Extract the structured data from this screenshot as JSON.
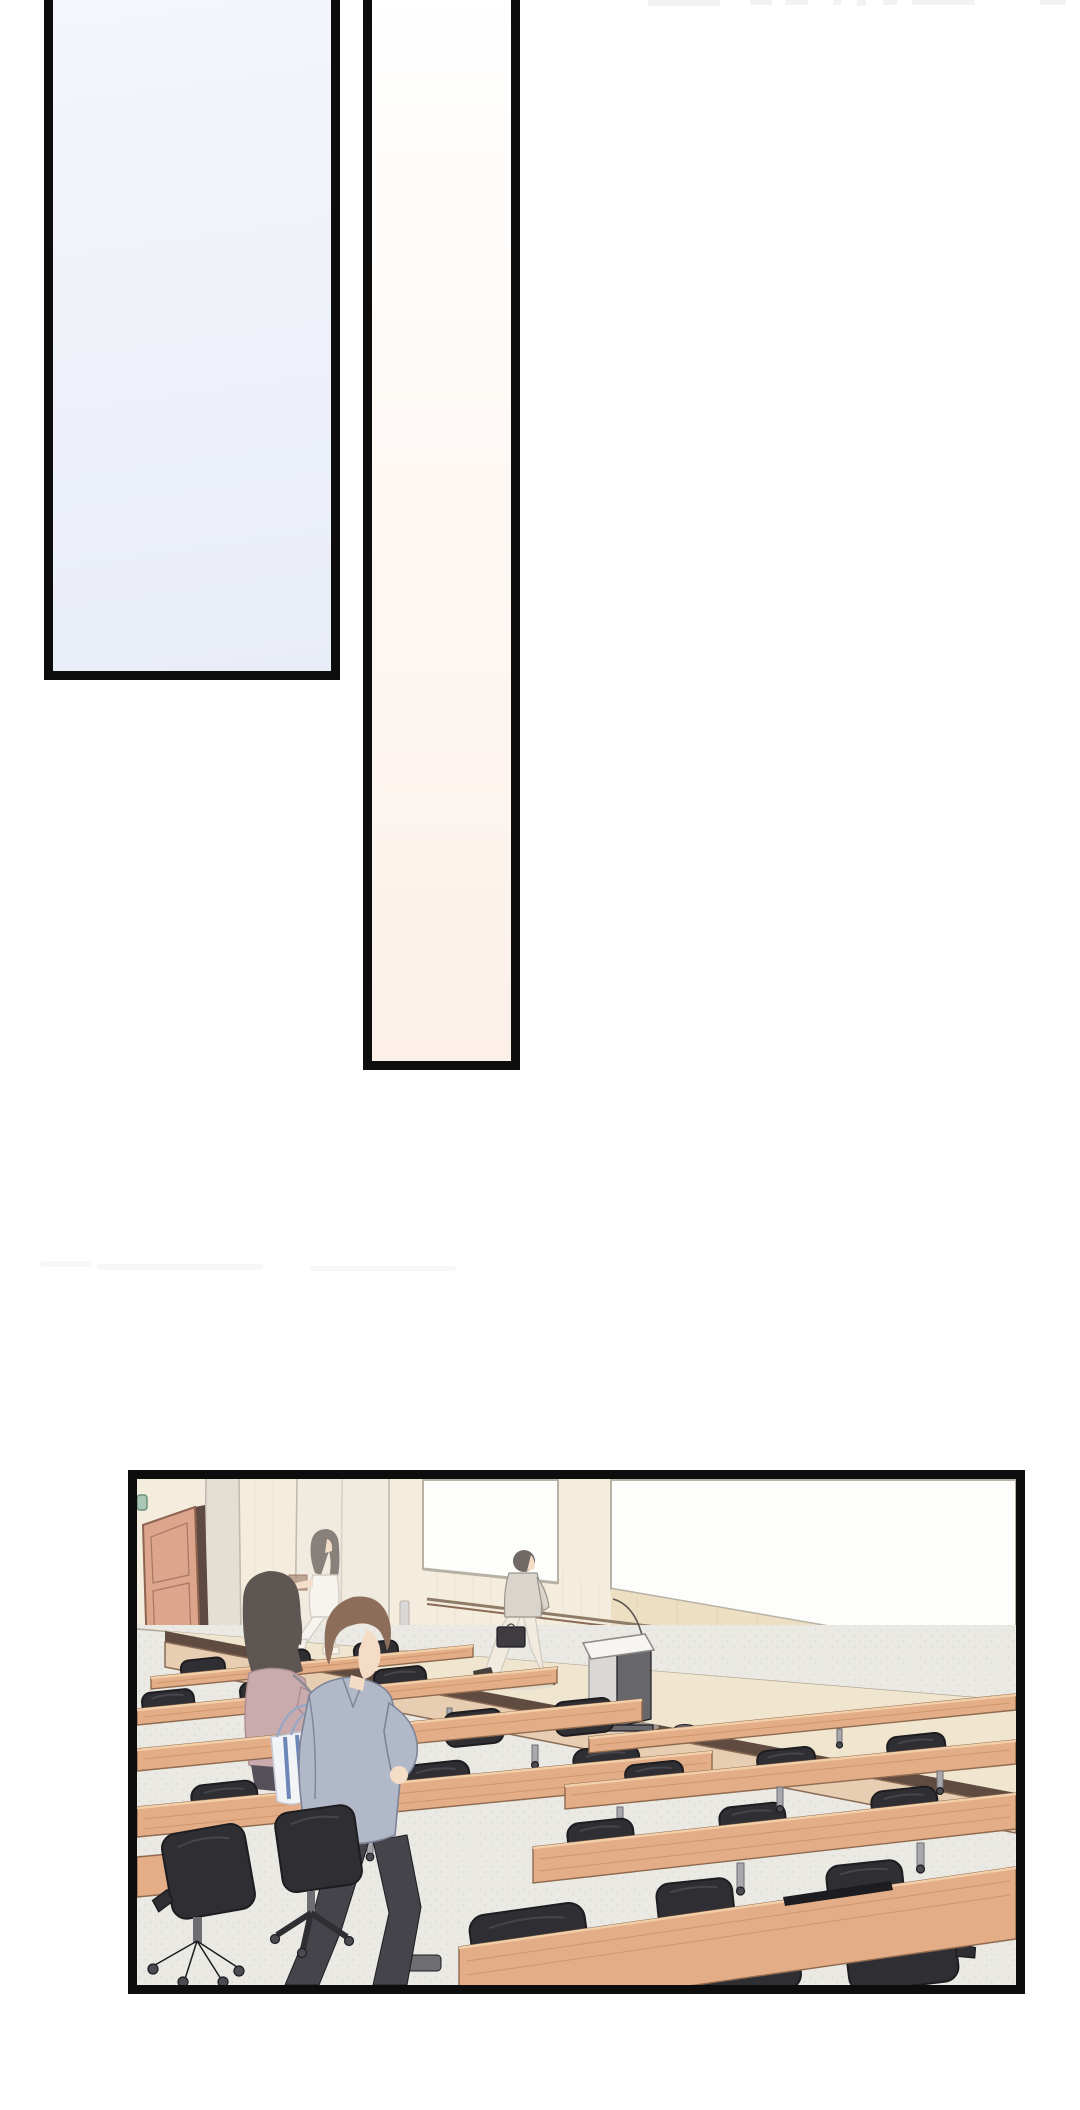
{
  "page": {
    "kind": "webtoon-comic-page",
    "visible_text": "",
    "panel_count": 3
  },
  "panels": {
    "tall_left": {
      "description": "empty tall panel, pale blue gradient, cropped at page top"
    },
    "tall_center": {
      "description": "empty narrow tall panel, white fading to pale pink, cropped at page top"
    },
    "lecture_hall": {
      "description": "wide panel: empty lecture hall with wooden desk rows, black office chairs, stage, podium, whiteboard; man in grey jacket walking with tote bag, seated woman with white bag, person exiting door, man crossing stage with briefcase"
    }
  },
  "css_vars": {
    "page-bg": "#ffffff",
    "ink": "#0d0d0d",
    "smudge": "#f2f2f2",
    "streak": "#f7f7f6",
    "p1-top": "#f4f6fb",
    "p1-mid": "#eef1f9",
    "p1-bot": "#e9edf8",
    "p2-top": "#ffffff",
    "p2-mid": "#fdf6f1",
    "p2-bot": "#fcf0e9",
    "wall": "#f4eddd",
    "wall-line": "#d8cdb4",
    "whiteboard": "#fdfdfc",
    "wb-frame": "#b8b2a6",
    "wood-panel": "#eddfc2",
    "rail": "#8f7c68",
    "door": "#dca58c",
    "door-dark": "#8e6450",
    "door-gap": "#5e4a40",
    "exit-sign": "#aac8b5",
    "exit-frame": "#6c8f7c",
    "column": "#f1ebdf",
    "column2": "#e5dfd3",
    "col-edge": "#c2bab0",
    "stage-top": "#f0e6cf",
    "stage-band": "#5f4b40",
    "stage-face": "#e7ceb2",
    "stage-face-line": "#8a6a55",
    "base-line": "#b3a795",
    "floor": "#eae9e4",
    "floor-dot": "#d9d8d2",
    "outlet": "#6b6a6e",
    "desk": "#e2ad87",
    "desk-edge": "#8f6a4e",
    "desk-hi": "#f3cfa9",
    "desk-streak": "#c98f63",
    "chair": "#2f2e33",
    "chair-dark": "#1d1c20",
    "chair-hi": "#4c4b52",
    "leg": "#a9a9ad",
    "leg-dark": "#6e6d72",
    "skin": "#f4dcc6",
    "hair-man": "#8b6d5a",
    "jacket": "#b1b8c8",
    "jacket-line": "#7d8498",
    "pants": "#46444b",
    "tote": "#f1f3f6",
    "tote-edge": "#c5c9d2",
    "tote-stripe": "#6d86b8",
    "tote-strap": "#9aa7c4",
    "hair-woman": "#5e5653",
    "cardigan": "#c9abae",
    "cardigan-line": "#ab8e92",
    "bag": "#f4f3f1",
    "bag-line": "#b7b6b8",
    "strap": "#8d8d93",
    "skirt": "#55505a",
    "hair-exit": "#716965",
    "white-cloth": "#f8f6f3",
    "cloth-line": "#cfc9c0",
    "cloth-line2": "#9a948a",
    "box": "#b39683",
    "shirt-stage": "#dad5cc",
    "pants-stage": "#f0eadf",
    "case": "#3e3c40",
    "shoe": "#45403c",
    "podium-light": "#f6f5f3",
    "podium-mid": "#d9d8d6",
    "podium-dark": "#67666b",
    "podium-edge": "#8e8a84",
    "cable": "#5a5650",
    "shadow": "#d8d6cf"
  }
}
